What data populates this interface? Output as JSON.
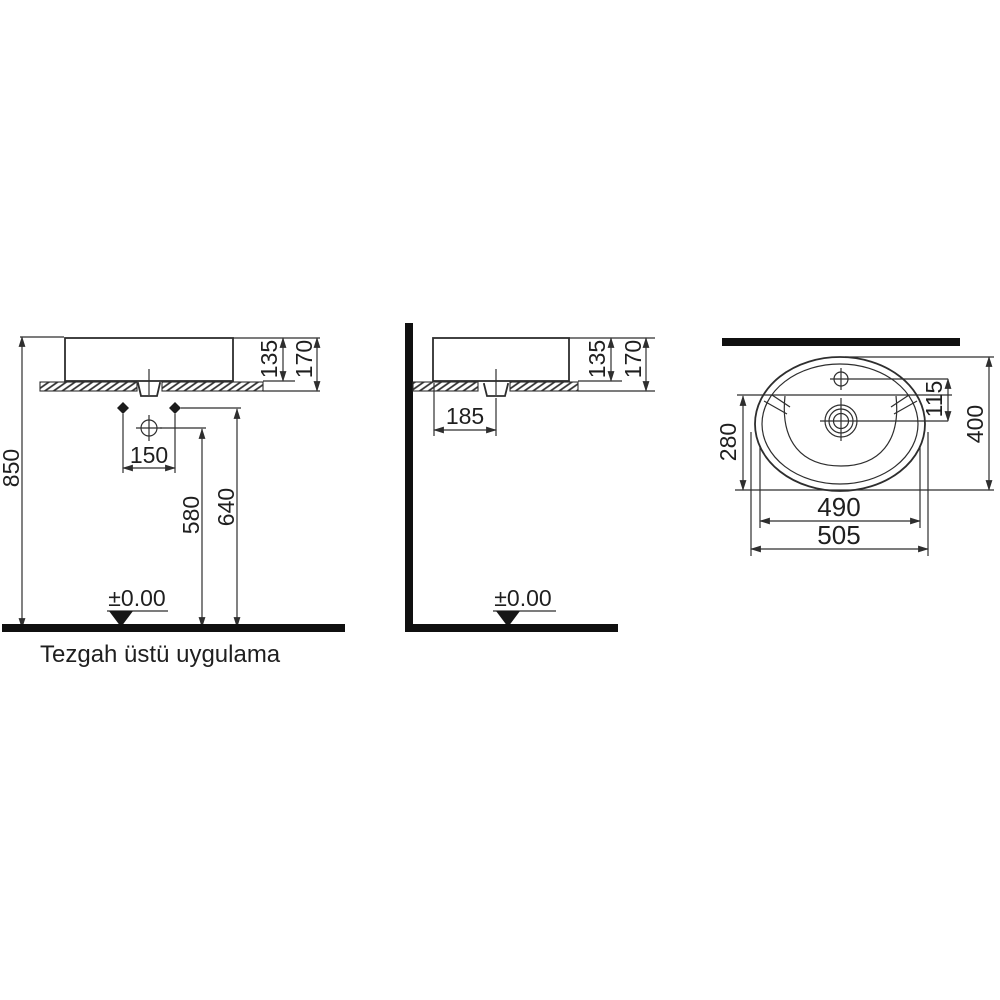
{
  "caption": "Tezgah üstü uygulama",
  "front_view": {
    "dim_height_total": "850",
    "dim_basin_height": "135",
    "dim_basin_counter_height": "170",
    "dim_hole_spacing": "150",
    "dim_tap_height": "580",
    "dim_hole_height": "640",
    "datum_level": "±0.00"
  },
  "side_view": {
    "dim_basin_height": "135",
    "dim_basin_counter_height": "170",
    "dim_drain_offset": "185",
    "datum_level": "±0.00"
  },
  "top_view": {
    "dim_tap_to_drain": "115",
    "dim_bowl_depth": "280",
    "dim_total_depth": "400",
    "dim_inner_width": "490",
    "dim_total_width": "505"
  },
  "colors": {
    "line": "#2e2e2e",
    "thick": "#101010",
    "background": "#ffffff"
  }
}
